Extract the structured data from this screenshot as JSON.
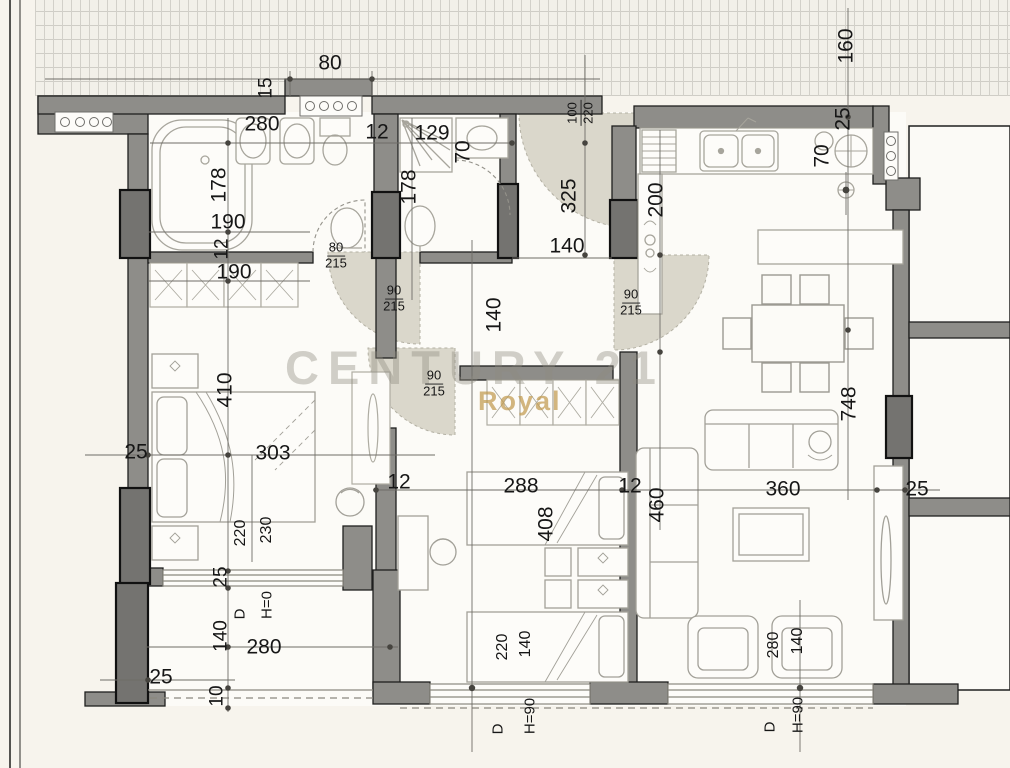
{
  "watermark": {
    "brand": "CENTURY 21",
    "sub": "Royal"
  },
  "dims": [
    "80",
    "15",
    "280",
    "12",
    "129",
    "70",
    "160",
    "25",
    "70",
    "178",
    "178",
    "190",
    "12",
    "190",
    "325",
    "200",
    "140",
    "140",
    "410",
    "303",
    "25",
    "12",
    "288",
    "12",
    "460",
    "360",
    "25",
    "748",
    "408",
    "220",
    "230",
    "25",
    "D",
    "H=0",
    "140",
    "280",
    "25",
    "10",
    "220",
    "140",
    "D",
    "H=90",
    "280",
    "140",
    "D",
    "H=90"
  ],
  "doors": [
    {
      "w": "100",
      "h": "220"
    },
    {
      "w": "80",
      "h": "215"
    },
    {
      "w": "90",
      "h": "215"
    },
    {
      "w": "90",
      "h": "215"
    },
    {
      "w": "90",
      "h": "215"
    }
  ]
}
